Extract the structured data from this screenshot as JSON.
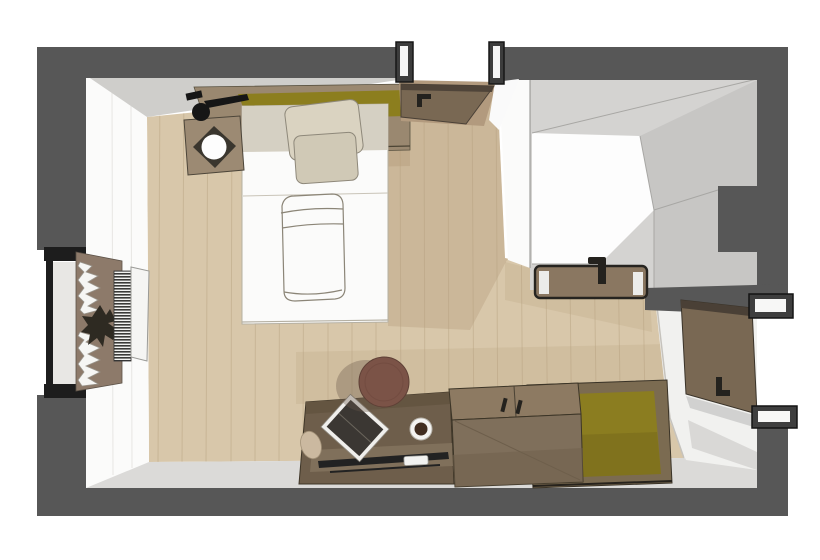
{
  "meta": {
    "kind": "3d-floor-plan-rendering",
    "description": "Top-down dollhouse view of a hotel-style bedroom with ensuite bathroom and entry",
    "visible_text": ""
  },
  "canvas": {
    "width": 820,
    "height": 560
  },
  "palette": {
    "outside": "#ffffff",
    "wall_top": "#575757",
    "wall_face_light": "#fbfbfa",
    "wall_face_shaded": "#cfcecb",
    "apron_gray": "#dbdad8",
    "floor_wood": "#d8c7aa",
    "floor_plank_line": "#c0ac8c",
    "floor_shadow": "#b59e7d",
    "hall_wood": "#b29a7e",
    "shelf_wood": "#9a8870",
    "headboard_olive": "#8c7e1e",
    "bench_olive": "#8b7d20",
    "bed_white": "#fbfbfa",
    "bed_sheet": "#d5d0c3",
    "pillow": "#dad3c1",
    "pillow2": "#d0c9b6",
    "sketch_line": "#8b8577",
    "nightstand_wood": "#9c8a73",
    "lamp_black": "#161616",
    "curtain_board": "#8d7a6a",
    "curtain_white": "#f6f6f4",
    "plant_dark": "#2e2a22",
    "desk_wood": "#6e5e4b",
    "desk_ledge": "#81715c",
    "tv_black": "#222222",
    "stool_leather": "#7b5347",
    "book_cover": "#3b3733",
    "coffee": "#412d20",
    "remote_white": "#f2f2f0",
    "cabinet_top": "#8d7a62",
    "cabinet_front": "#7f6f5b",
    "door_wood": "#796853",
    "door_edge": "#4a4036",
    "handle_dark": "#24221e",
    "frame_black": "#1d1d1d",
    "bath_floor": "#fdfdfd",
    "bath_wall_gray": "#d4d3d1",
    "bath_wall_gray2": "#c7c6c4",
    "vanity_wood": "#8a7761",
    "vestibule_floor": "#f1f1ef",
    "sill_gray": "#e8e7e4",
    "paper_beige": "#cbb9a0"
  },
  "scene": {
    "rooms": [
      {
        "name": "bedroom",
        "furniture": [
          "double-bed",
          "pillows",
          "duvet-sketch",
          "headboard-shelf",
          "olive-headboard-cushion",
          "nightstand",
          "reading-lamp",
          "window",
          "curtains",
          "plant",
          "radiator",
          "desk",
          "tv",
          "remote",
          "book",
          "coffee-cup",
          "round-stool",
          "cabinet",
          "luggage-bench"
        ]
      },
      {
        "name": "bathroom",
        "furniture": [
          "vanity-counter",
          "faucet",
          "shower-walls"
        ]
      },
      {
        "name": "entry-vestibule",
        "furniture": [
          "entry-door"
        ]
      }
    ],
    "doors": [
      "top-doorway-open-door",
      "entry-door-open",
      "bathroom-wall-vanity"
    ],
    "windows": [
      "left-window-with-curtains"
    ]
  }
}
